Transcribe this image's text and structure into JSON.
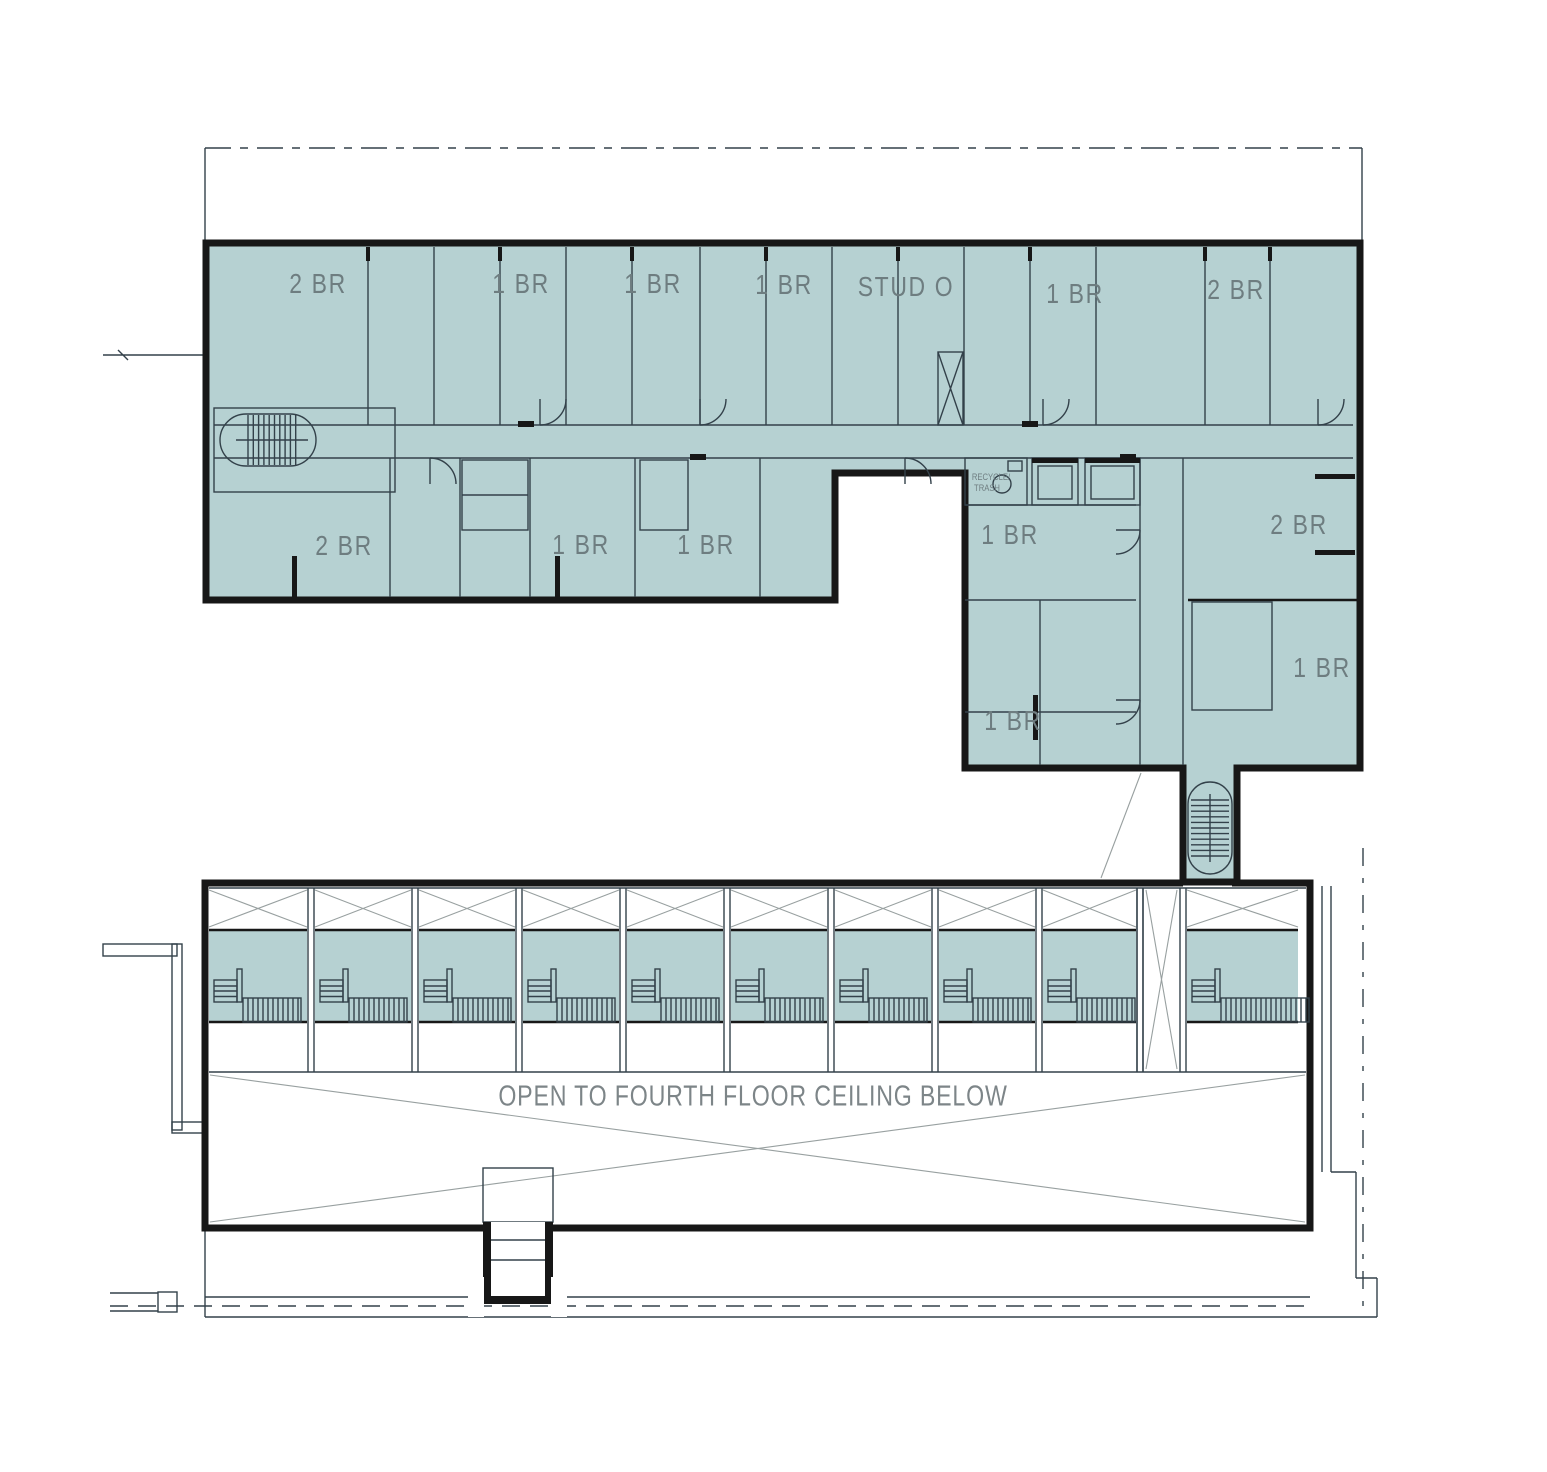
{
  "colors": {
    "unit_fill": "#b6d1d2",
    "wall": "#171717",
    "line": "#33414a",
    "faint": "#98a0a0",
    "label": "#6e7d80",
    "open": "#7d8588",
    "hatch": "#8c8c8c"
  },
  "plan": {
    "unit_labels": [
      {
        "text": "2 BR",
        "x": 318,
        "y": 284
      },
      {
        "text": "1 BR",
        "x": 521,
        "y": 284
      },
      {
        "text": "1 BR",
        "x": 653,
        "y": 284
      },
      {
        "text": "1 BR",
        "x": 784,
        "y": 285
      },
      {
        "text": "STUD O",
        "x": 906,
        "y": 287
      },
      {
        "text": "1 BR",
        "x": 1075,
        "y": 294
      },
      {
        "text": "2 BR",
        "x": 1236,
        "y": 290
      },
      {
        "text": "2 BR",
        "x": 344,
        "y": 546
      },
      {
        "text": "1 BR",
        "x": 581,
        "y": 545
      },
      {
        "text": "1 BR",
        "x": 706,
        "y": 545
      },
      {
        "text": "1 BR",
        "x": 1010,
        "y": 535
      },
      {
        "text": "2 BR",
        "x": 1299,
        "y": 525
      },
      {
        "text": "1 BR",
        "x": 1013,
        "y": 721
      },
      {
        "text": "1 BR",
        "x": 1322,
        "y": 668
      }
    ],
    "open_area_note": {
      "text": "OPEN TO FOURTH FLOOR CEILING BELOW",
      "x": 753,
      "y": 1097
    },
    "utility_labels": [
      {
        "text": "RECYCLE/",
        "x": 991,
        "y": 477
      },
      {
        "text": "TRASH",
        "x": 987,
        "y": 488
      }
    ],
    "storage_cell_count": 10
  }
}
